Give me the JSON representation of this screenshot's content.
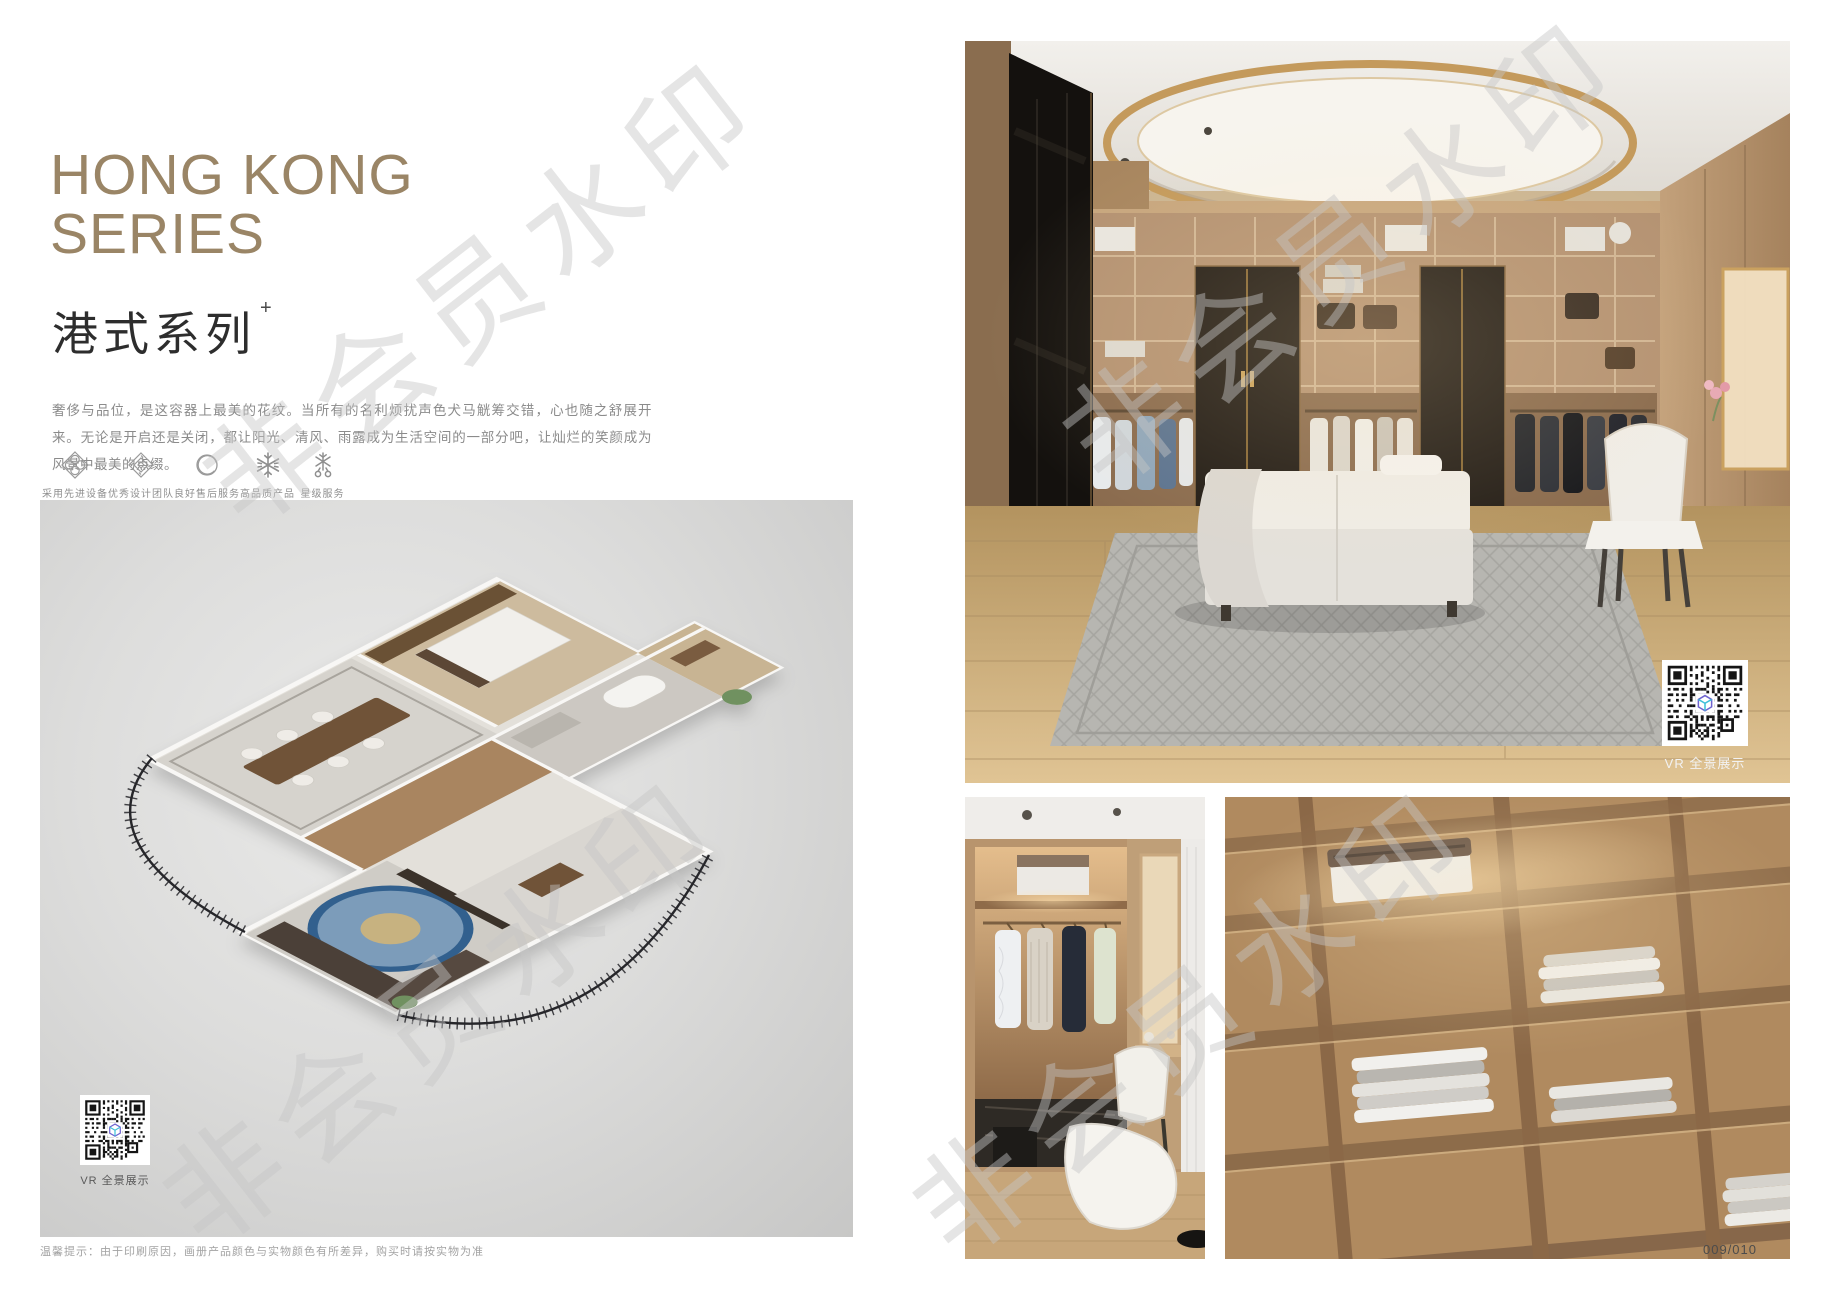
{
  "header": {
    "title_line1": "HONG KONG",
    "title_line2": "SERIES",
    "subtitle": "港式系列",
    "subtitle_superscript": "+",
    "description": "奢侈与品位，是这容器上最美的花纹。当所有的名利烦扰声色犬马觥筹交错，心也随之舒展开来。无论是开启还是关闭，都让阳光、清风、雨露成为生活空间的一部分吧，让灿烂的笑颜成为风景中最美的点缀。"
  },
  "features": [
    {
      "icon": "ornate-flower-icon",
      "label": "采用先进设备"
    },
    {
      "icon": "ornate-diamond-icon",
      "label": "优秀设计团队"
    },
    {
      "icon": "ring-icon",
      "label": "良好售后服务"
    },
    {
      "icon": "snowflake-icon",
      "label": "高品质产品"
    },
    {
      "icon": "star-service-icon",
      "label": "星级服务"
    }
  ],
  "floorplan": {
    "vr_label": "VR 全景展示"
  },
  "gallery": {
    "vr_label": "VR 全景展示"
  },
  "watermark": {
    "text": "非会员水印"
  },
  "footer": {
    "disclaimer": "温馨提示：由于印刷原因，画册产品颜色与实物颜色有所差异，购买时请按实物为准",
    "page_number": "009/010"
  },
  "colors": {
    "title_tan": "#9a8566",
    "accent_gold": "#b08d57"
  }
}
